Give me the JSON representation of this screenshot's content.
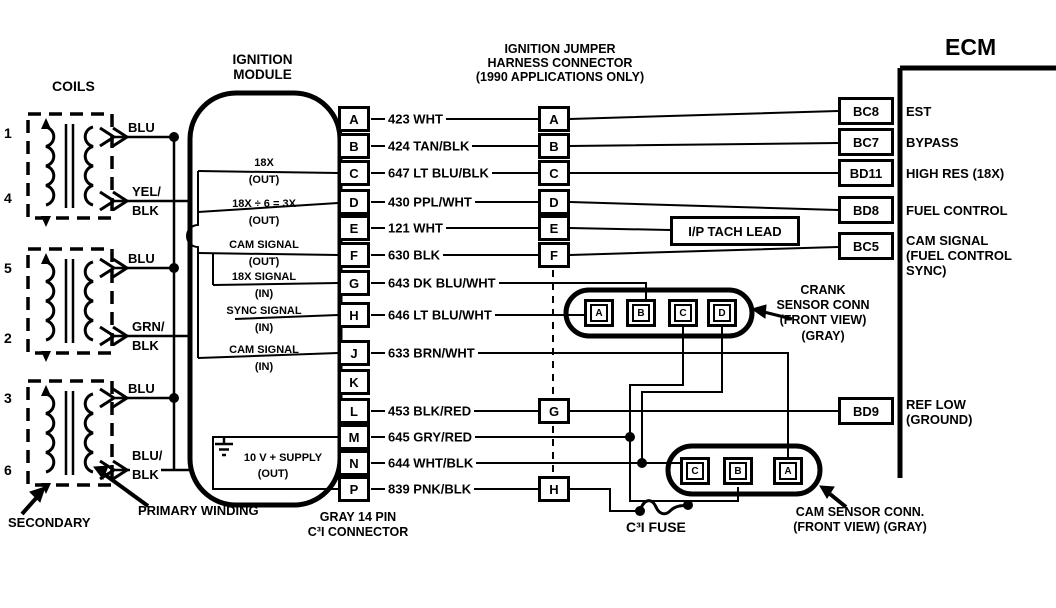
{
  "colors": {
    "ink": "#000000",
    "paper": "#ffffff"
  },
  "headers": {
    "coils": "COILS",
    "ignition_module_l1": "IGNITION",
    "ignition_module_l2": "MODULE",
    "jumper_l1": "IGNITION JUMPER",
    "jumper_l2": "HARNESS CONNECTOR",
    "jumper_l3": "(1990 APPLICATIONS ONLY)",
    "ecm": "ECM",
    "gray_l1": "GRAY 14 PIN",
    "gray_l2": "C³I CONNECTOR",
    "secondary": "SECONDARY",
    "primary": "PRIMARY WINDING",
    "tach_lead": "I/P TACH LEAD",
    "fuse": "C³I  FUSE",
    "crank_l1": "CRANK",
    "crank_l2": "SENSOR CONN",
    "crank_l3": "(FRONT VIEW)",
    "crank_l4": "(GRAY)",
    "cam_l1": "CAM SENSOR CONN.",
    "cam_l2": "(FRONT VIEW) (GRAY)"
  },
  "coils": {
    "numbers": [
      "1",
      "4",
      "5",
      "2",
      "3",
      "6"
    ],
    "wire_labels": [
      "BLU",
      "YEL/",
      "BLK",
      "BLU",
      "GRN/",
      "BLK",
      "BLU",
      "BLU/",
      "BLK"
    ]
  },
  "module": {
    "pins": [
      "A",
      "B",
      "C",
      "D",
      "E",
      "F",
      "G",
      "H",
      "J",
      "K",
      "L",
      "M",
      "N",
      "P"
    ],
    "signals": [
      {
        "name": "18X",
        "dir": "(OUT)"
      },
      {
        "name": "18X ÷ 6 = 3X",
        "dir": "(OUT)"
      },
      {
        "name": "CAM SIGNAL",
        "dir": "(OUT)"
      },
      {
        "name": "18X SIGNAL",
        "dir": "(IN)"
      },
      {
        "name": "SYNC SIGNAL",
        "dir": "(IN)"
      },
      {
        "name": "CAM SIGNAL",
        "dir": "(IN)"
      }
    ],
    "supply": "10 V + SUPPLY",
    "supply_dir": "(OUT)"
  },
  "wires": [
    "423 WHT",
    "424 TAN/BLK",
    "647 LT BLU/BLK",
    "430 PPL/WHT",
    "121 WHT",
    "630 BLK",
    "643 DK BLU/WHT",
    "646 LT BLU/WHT",
    "633 BRN/WHT",
    "453 BLK/RED",
    "645 GRY/RED",
    "644 WHT/BLK",
    "839 PNK/BLK"
  ],
  "jumper": {
    "pins": [
      "A",
      "B",
      "C",
      "D",
      "E",
      "F"
    ],
    "pin_g": "G",
    "pin_h": "H"
  },
  "ecm": {
    "pins": [
      {
        "id": "BC8",
        "label": "EST"
      },
      {
        "id": "BC7",
        "label": "BYPASS"
      },
      {
        "id": "BD11",
        "label": "HIGH RES (18X)"
      },
      {
        "id": "BD8",
        "label": "FUEL CONTROL"
      },
      {
        "id": "BC5",
        "label": "CAM SIGNAL",
        "label2": "(FUEL CONTROL",
        "label3": "SYNC)"
      },
      {
        "id": "BD9",
        "label": "REF LOW",
        "label2": "(GROUND)"
      }
    ]
  },
  "crank": {
    "pins": [
      "A",
      "B",
      "C",
      "D"
    ]
  },
  "cam": {
    "pins": [
      "C",
      "B",
      "A"
    ]
  }
}
